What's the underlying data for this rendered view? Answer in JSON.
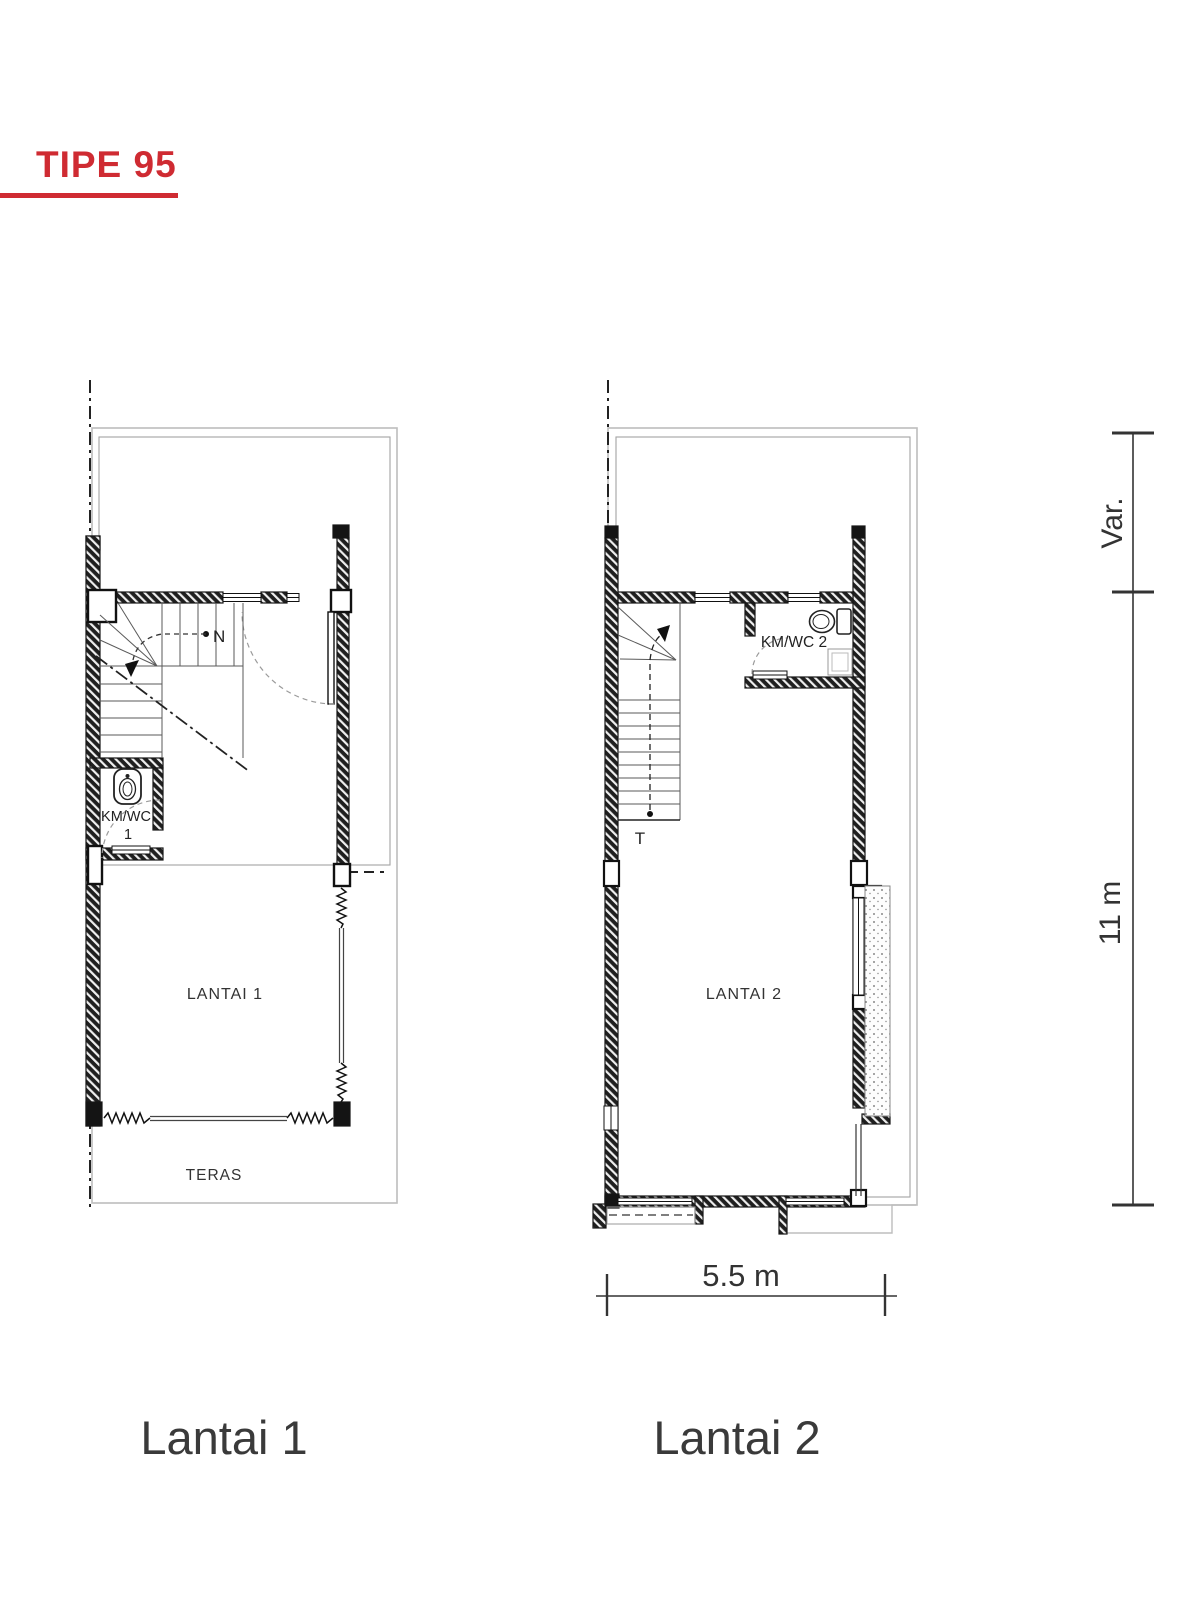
{
  "title": {
    "label": "TIPE 95",
    "accent_color": "#cf2b32"
  },
  "plans": {
    "lantai1": {
      "caption": "Lantai 1",
      "room_label": "LANTAI 1",
      "teras_label": "TERAS",
      "bath_label_line1": "KM/WC",
      "bath_label_line2": "1",
      "stair_marker": "N"
    },
    "lantai2": {
      "caption": "Lantai 2",
      "room_label": "LANTAI 2",
      "bath_label": "KM/WC 2",
      "stair_marker": "T"
    }
  },
  "dimensions": {
    "width_label": "5.5 m",
    "height_label": "11 m",
    "front_label": "Var."
  }
}
